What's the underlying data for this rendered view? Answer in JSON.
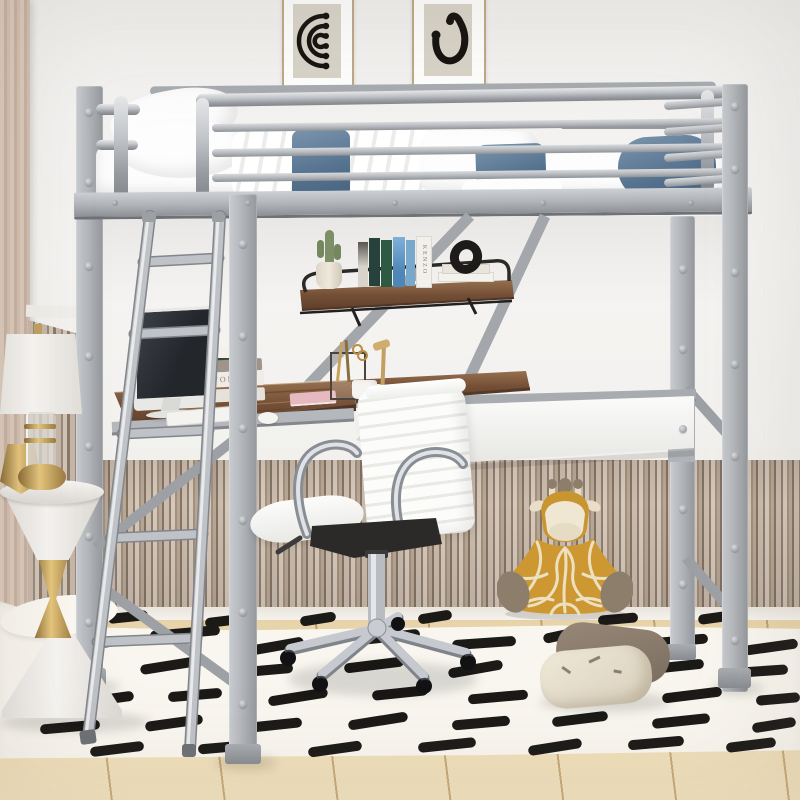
{
  "meta": {
    "description": "Product photo of a silver metal twin loft bed with guard rails, built-in ladder, hanging shelf and L-shaped desk underneath, styled with white bedding, denim pillows, iMac-style computer, white ribbed office chair, marble side table with lamp, giraffe plush, floor pillows and a black-dash patterned white rug over light wood flooring"
  },
  "palette": {
    "wall": "#f3f2f0",
    "frame_silver": "#b3b6ba",
    "wainscot_light": "#d7c9ba",
    "wainscot_dark": "#847464",
    "desk_wood": "#744f36",
    "rug": "#f9f6ef",
    "rug_dash": "#1c1a17",
    "denim_pillow": "#54718d",
    "floor_wood": "#ecd9b4",
    "chair_white": "#fafaf9",
    "chrome": "#c3c7cc",
    "gold": "#c2a061",
    "giraffe_gold": "#c9952f"
  },
  "artwork": {
    "left_print": "black concentric arcs with dotted ends on beige",
    "right_print": "black ear-shaped curve with dots on beige"
  },
  "books": {
    "desk_stack_spine": "NFOLK",
    "shelf_book_spine": "KENZO"
  },
  "decor": {
    "rug_dashes": [
      [
        60,
        640,
        56,
        -8
      ],
      [
        150,
        628,
        70,
        -5
      ],
      [
        250,
        641,
        54,
        -10
      ],
      [
        358,
        632,
        62,
        -6
      ],
      [
        452,
        638,
        64,
        -4
      ],
      [
        543,
        630,
        40,
        -12
      ],
      [
        648,
        636,
        60,
        -5
      ],
      [
        744,
        642,
        54,
        -8
      ],
      [
        34,
        668,
        60,
        -6
      ],
      [
        140,
        660,
        66,
        -9
      ],
      [
        243,
        665,
        50,
        -5
      ],
      [
        344,
        660,
        60,
        -7
      ],
      [
        448,
        664,
        55,
        -10
      ],
      [
        638,
        662,
        66,
        -6
      ],
      [
        738,
        666,
        50,
        -4
      ],
      [
        70,
        695,
        64,
        -8
      ],
      [
        168,
        690,
        54,
        -5
      ],
      [
        268,
        692,
        60,
        -9
      ],
      [
        372,
        688,
        56,
        -6
      ],
      [
        468,
        692,
        60,
        -5
      ],
      [
        568,
        688,
        44,
        -10
      ],
      [
        662,
        690,
        60,
        -7
      ],
      [
        756,
        694,
        44,
        -5
      ],
      [
        40,
        722,
        60,
        -5
      ],
      [
        145,
        718,
        58,
        -8
      ],
      [
        248,
        720,
        54,
        -6
      ],
      [
        348,
        716,
        60,
        -9
      ],
      [
        452,
        718,
        58,
        -5
      ],
      [
        552,
        714,
        56,
        -7
      ],
      [
        652,
        716,
        58,
        -6
      ],
      [
        752,
        720,
        44,
        -9
      ],
      [
        90,
        744,
        54,
        -7
      ],
      [
        198,
        742,
        58,
        -5
      ],
      [
        308,
        744,
        54,
        -8
      ],
      [
        418,
        740,
        58,
        -6
      ],
      [
        528,
        742,
        54,
        -9
      ],
      [
        628,
        738,
        56,
        -5
      ],
      [
        726,
        740,
        50,
        -7
      ],
      [
        108,
        612,
        40,
        -6
      ],
      [
        205,
        616,
        38,
        -7
      ],
      [
        300,
        614,
        36,
        -9
      ],
      [
        418,
        612,
        34,
        -9
      ],
      [
        598,
        614,
        40,
        -5
      ],
      [
        698,
        612,
        44,
        -8
      ]
    ],
    "screws": [
      {
        "x": 85,
        "ys": [
          108,
          178,
          262,
          352,
          442,
          532,
          618
        ]
      },
      {
        "x": 239,
        "ys": [
          240,
          332,
          424,
          516,
          608,
          700
        ]
      },
      {
        "x": 679,
        "ys": [
          265,
          345,
          425,
          505,
          580
        ]
      },
      {
        "x": 731,
        "ys": [
          102,
          165,
          268,
          360,
          452,
          544,
          636
        ]
      }
    ],
    "deck_bolts": {
      "y": 200,
      "xs": [
        112,
        245,
        392,
        540,
        688
      ]
    }
  }
}
